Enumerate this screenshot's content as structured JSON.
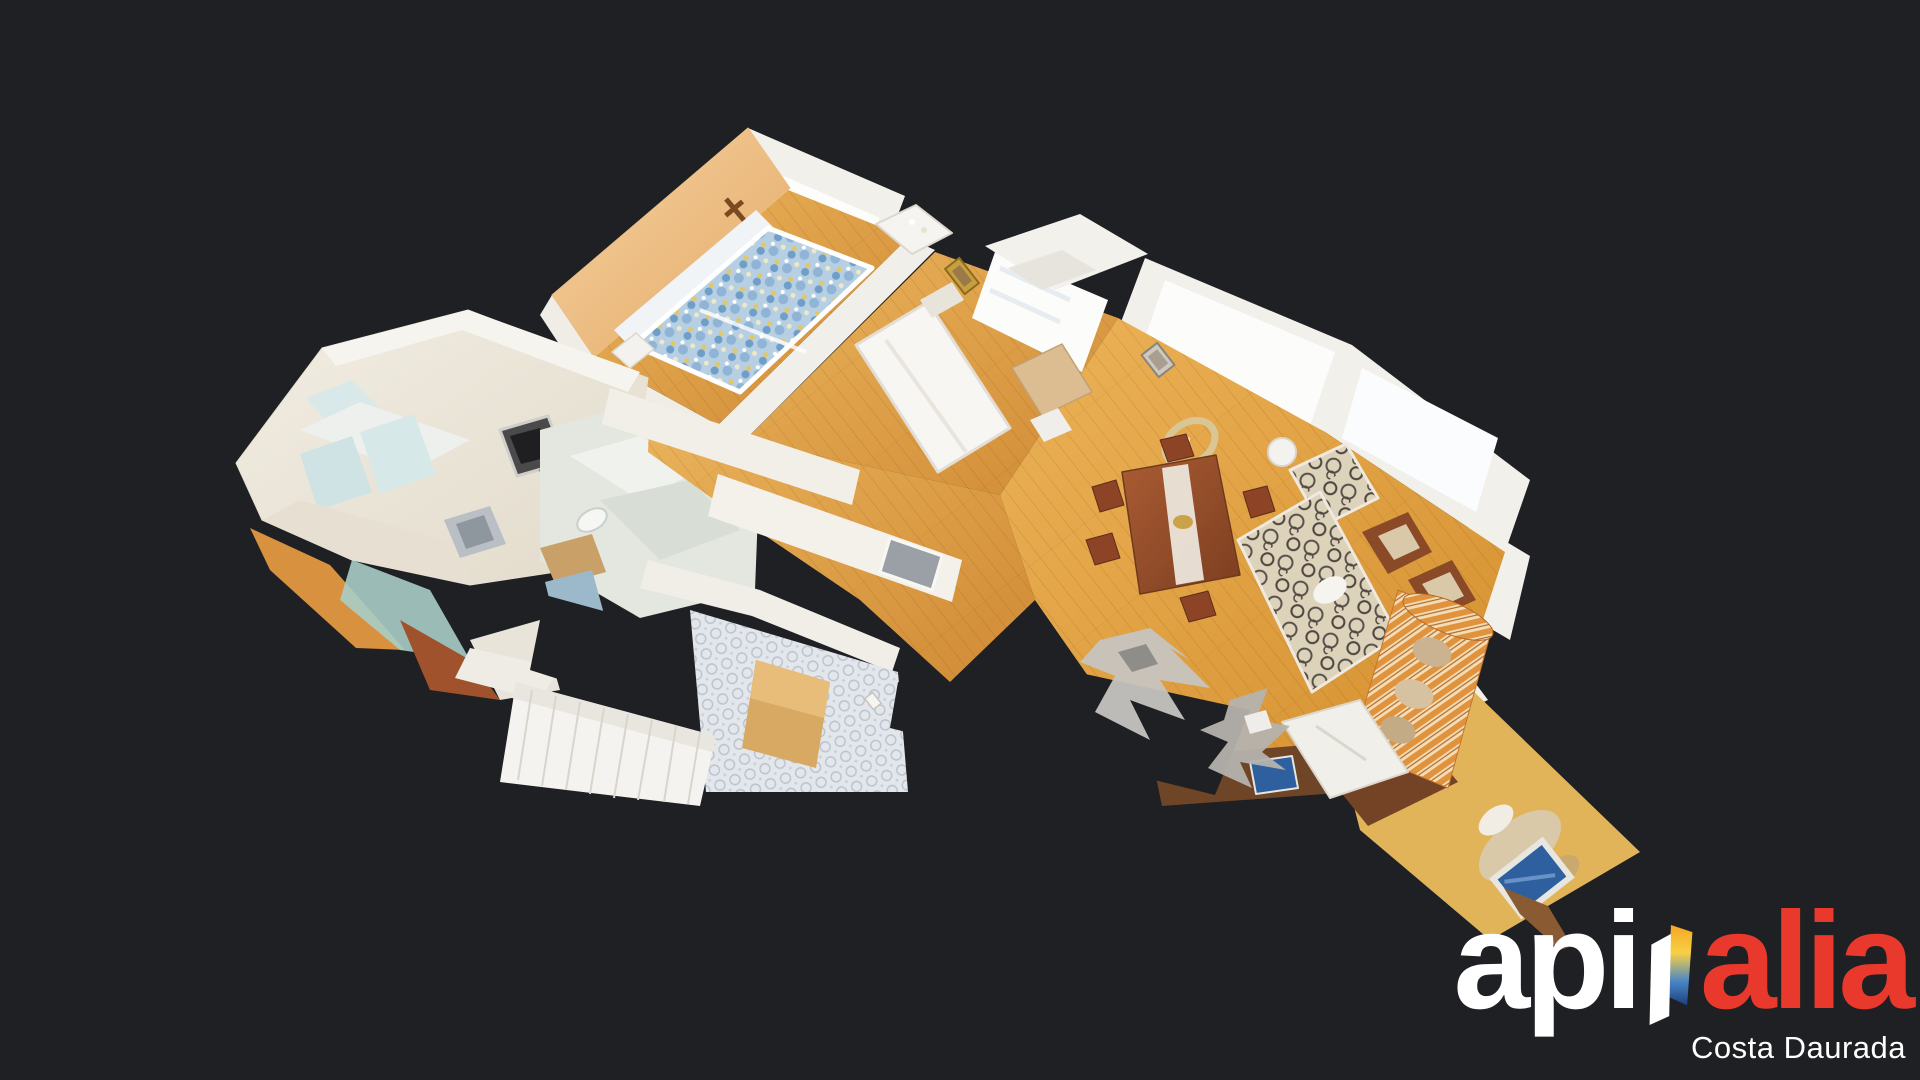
{
  "app": {
    "type": "3d-virtual-tour-viewer",
    "view_mode": "dollhouse",
    "background_color": "#1e2023"
  },
  "scene": {
    "subject": "apartment-3d-scan-dollhouse-top-down",
    "palette": {
      "wood_floor": "#dd9c45",
      "wood_floor_light": "#eab45c",
      "wall_white": "#f2f0ea",
      "wall_peach": "#edbf85",
      "window_glow": "#fcfcfb",
      "kitchen_cream": "#efe8dc",
      "tile_gray": "#e3e6ea",
      "tile_motif": "#b9c3cf",
      "sofa_stripe_orange": "#e0923c",
      "sofa_stripe_cream": "#f2ddb8",
      "sofa_pattern_cream": "#ddd3bb",
      "bedding_blue": "#b7cfe2",
      "table_wood": "#a65a32",
      "bench_wood": "#d8a963",
      "gallery_yellow": "#e2b45a",
      "sideboard_wood": "#744326",
      "tv_screen_blue": "#2e5f9e"
    }
  },
  "logo": {
    "brand_left": "api",
    "brand_right": "alia",
    "subtitle": "Costa Daurada",
    "colors": {
      "brand_left": "#ffffff",
      "brand_right": "#e8392c",
      "subtitle": "#ffffff",
      "door_panel": "#ffffff",
      "door_gradient_top": "#f5a623",
      "door_gradient_mid": "#f7d046",
      "door_gradient_lower": "#4a86c4",
      "door_gradient_bottom": "#1b3f7e"
    }
  }
}
